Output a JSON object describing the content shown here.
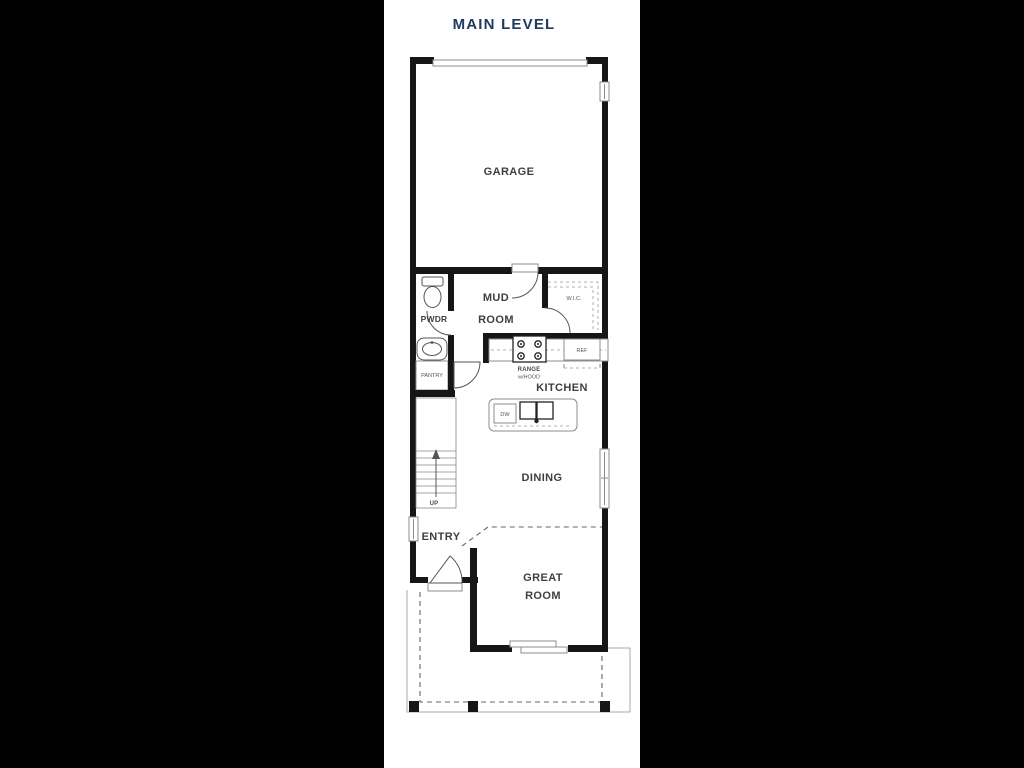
{
  "title": "MAIN LEVEL",
  "rooms": {
    "garage": "GARAGE",
    "mud_line1": "MUD",
    "mud_line2": "ROOM",
    "powder": "PWDR",
    "wic": "W.I.C.",
    "kitchen": "KITCHEN",
    "pantry": "PANTRY",
    "dining": "DINING",
    "entry": "ENTRY",
    "great_line1": "GREAT",
    "great_line2": "ROOM"
  },
  "fixtures": {
    "range_line1": "RANGE",
    "range_line2": "w/HOOD",
    "refrigerator": "REF",
    "dishwasher": "DW",
    "stairs_direction": "UP"
  },
  "colors": {
    "background": "#000000",
    "paper": "#ffffff",
    "wall": "#161616",
    "thin_line": "#8c8c8c",
    "label": "#3f3f3f",
    "title": "#20395e"
  }
}
